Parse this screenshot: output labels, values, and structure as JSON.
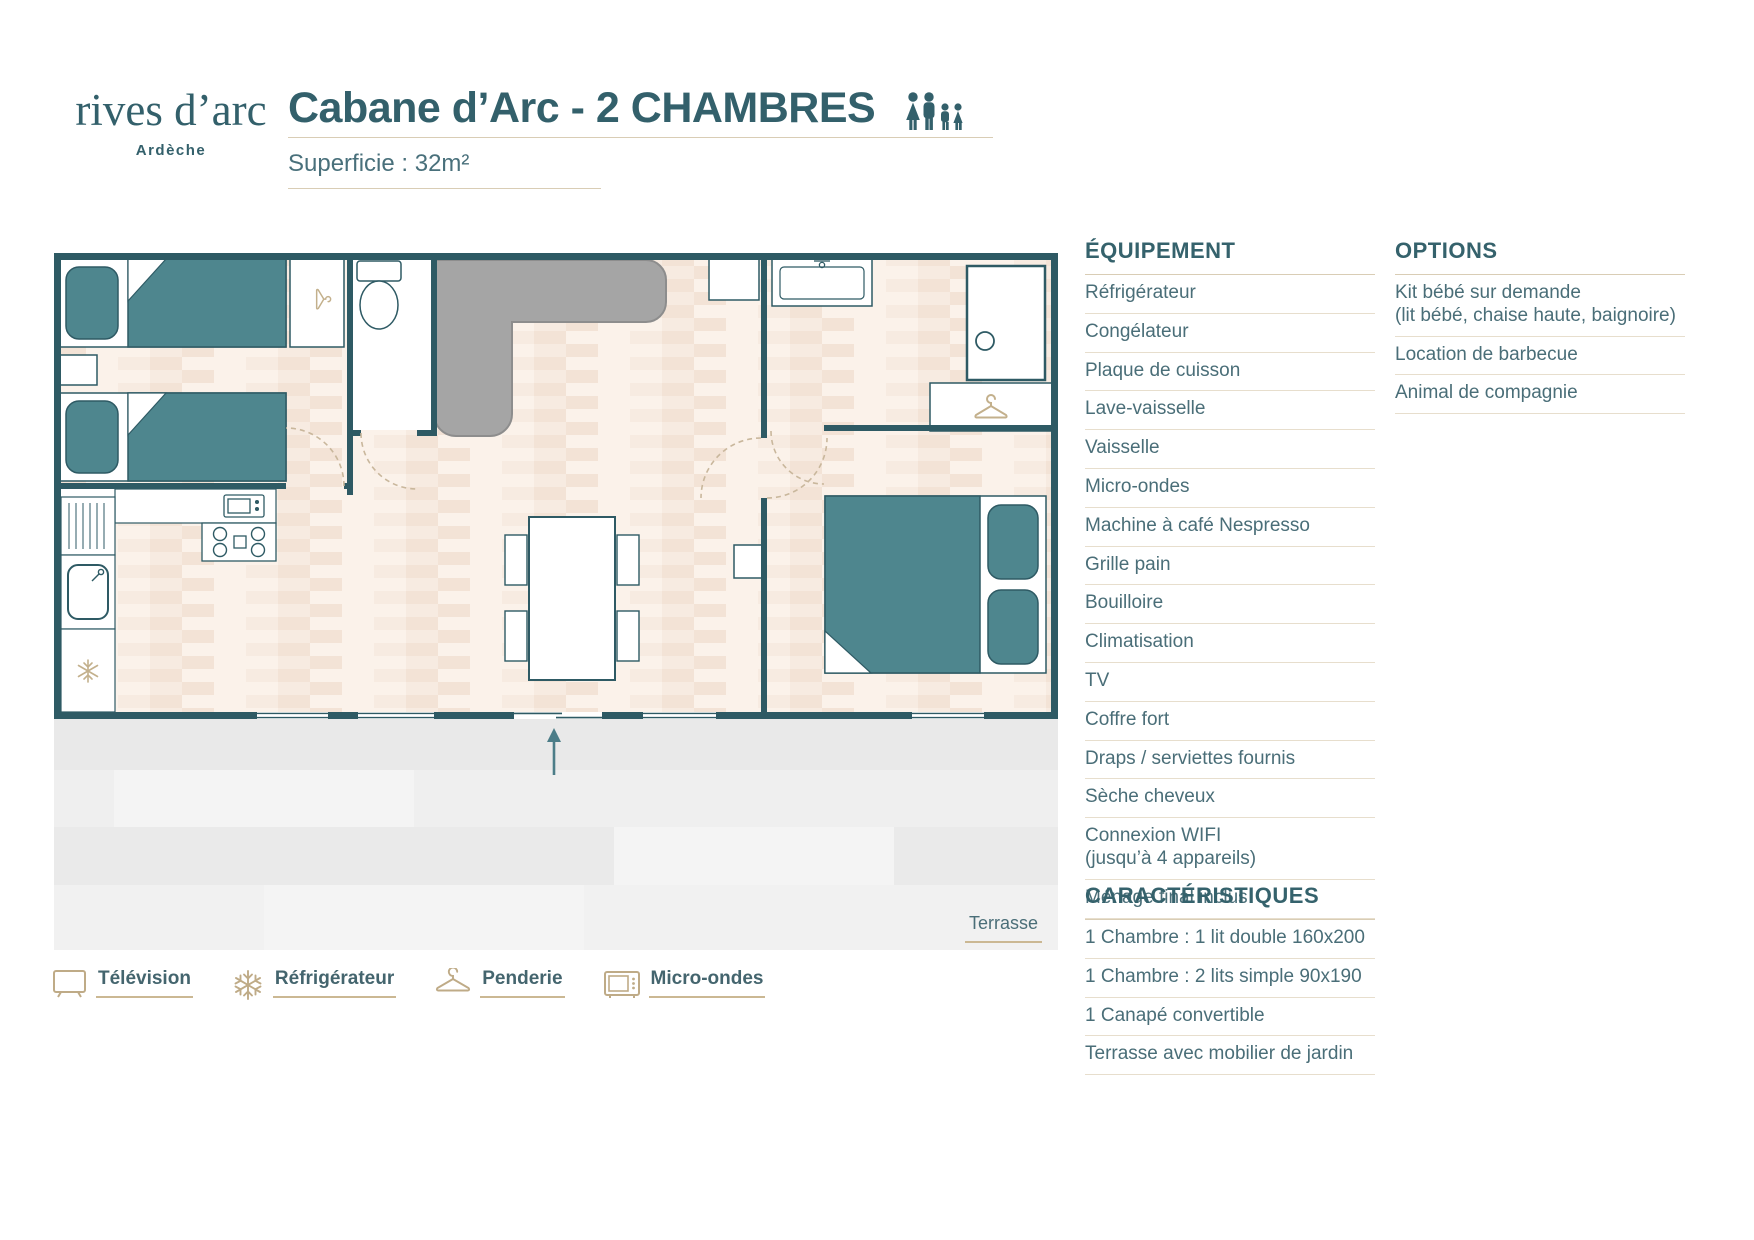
{
  "brand": {
    "name": "rives d’arc",
    "region": "Ardèche"
  },
  "header": {
    "title": "Cabane d’Arc - 2 CHAMBRES",
    "capacity": "4 personnes",
    "area_label": "Superficie : 32m²"
  },
  "plan": {
    "terrace_label": "Terrasse"
  },
  "legend": {
    "items": [
      {
        "icon": "tv-icon",
        "label": "Télévision"
      },
      {
        "icon": "snowflake-icon",
        "label": "Réfrigérateur"
      },
      {
        "icon": "hanger-icon",
        "label": "Penderie"
      },
      {
        "icon": "microwave-icon",
        "label": "Micro-ondes"
      }
    ]
  },
  "equipment": {
    "title": "ÉQUIPEMENT",
    "items": [
      "Réfrigérateur",
      "Congélateur",
      "Plaque de cuisson",
      "Lave-vaisselle",
      "Vaisselle",
      "Micro-ondes",
      "Machine à café Nespresso",
      "Grille pain",
      "Bouilloire",
      "Climatisation",
      "TV",
      "Coffre fort",
      "Draps / serviettes fournis",
      "Sèche cheveux",
      "Connexion WIFI\n(jusqu’à 4 appareils)",
      "Ménage final inclus"
    ]
  },
  "options": {
    "title": "OPTIONS",
    "items": [
      "Kit bébé sur demande\n(lit bébé, chaise haute, baignoire)",
      "Location de barbecue",
      "Animal de compagnie"
    ]
  },
  "characteristics": {
    "title": "CARACTÉRISTIQUES",
    "items": [
      "1 Chambre : 1 lit double 160x200",
      "1 Chambre : 2 lits simple 90x190",
      "1 Canapé convertible",
      "Terrasse avec mobilier de jardin"
    ]
  },
  "colors": {
    "wall": "#2e5a64",
    "furniture_teal": "#4e868e",
    "tan": "#c3b08c",
    "text_teal": "#35626c"
  }
}
